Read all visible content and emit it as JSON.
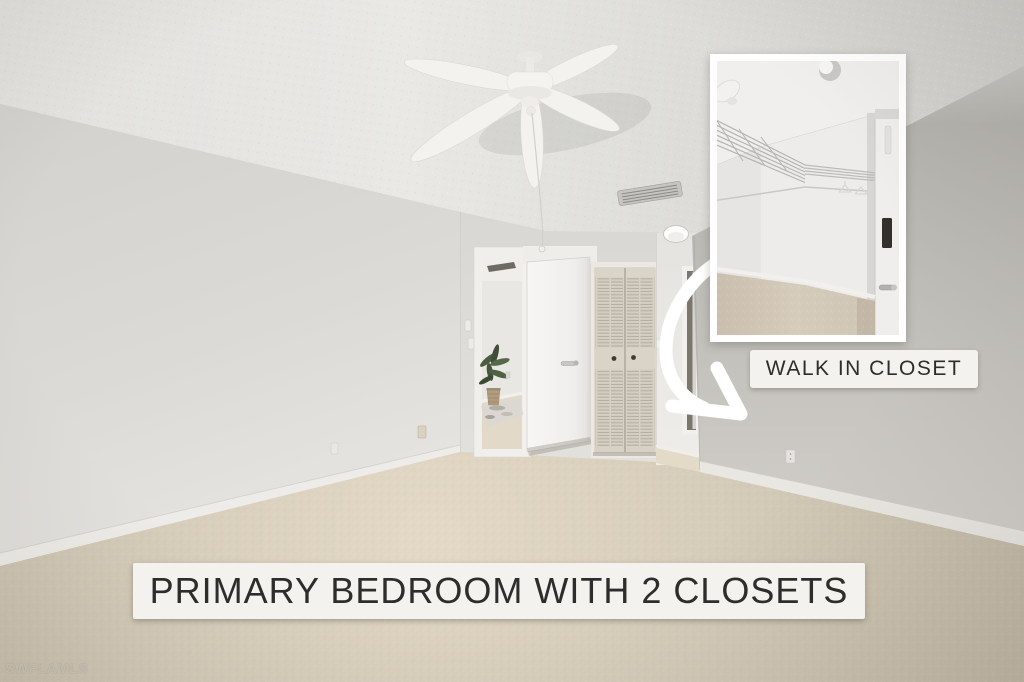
{
  "overlays": {
    "inset_caption": "WALK IN CLOSET",
    "banner": "PRIMARY BEDROOM WITH 2 CLOSETS"
  },
  "watermark": {
    "text": "SWFLAMLS"
  },
  "palette": {
    "label_bg": "#f4f2ee",
    "label_text": "#2e2d2b",
    "arrow": "#ffffff",
    "ceiling": "#e6e5e2",
    "left_wall": "#dcdad6",
    "right_wall": "#b9b7b2",
    "carpet": "#d5cbba",
    "door_white": "#f4f3f1",
    "closet_door_beige": "#d6d0c5"
  },
  "annotations": {
    "arrow_icon": "curved-arrow-down-right",
    "scene_objects": [
      "ceiling-fan",
      "bedroom-door",
      "louvered-closet-doors",
      "hallway",
      "walk-in-closet-inset-photo",
      "potted-plant",
      "ceiling-vent"
    ]
  }
}
